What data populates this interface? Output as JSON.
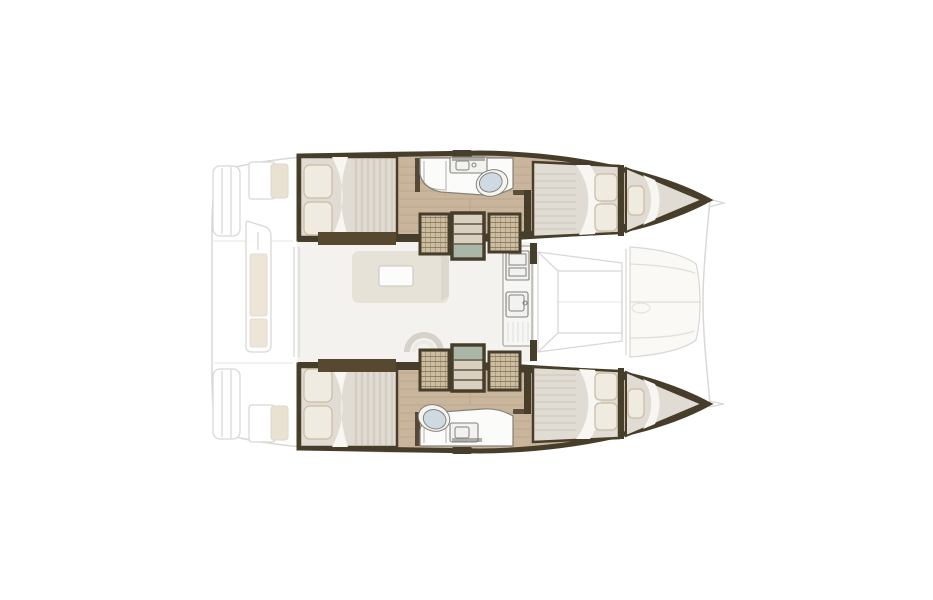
{
  "image": {
    "description": "Top-down interior layout plan of a catamaran yacht, bow pointing right, on a white background",
    "background": "#ffffff"
  },
  "colors": {
    "background": "#ffffff",
    "hull-wall": "#473d2b",
    "wood-floor": "#c8b59c",
    "wood-plank-line": "#b09c82",
    "mattress": "#e1dcd3",
    "mattress-stripe": "#d2ccc1",
    "bed-sheet": "#f7f6f2",
    "pillow": "#f0ebe1",
    "pillow-edge": "#c9bba2",
    "cabinet-hatch": "#cdbda0",
    "cabinet-line": "#6e6146",
    "stair-tread": "#d9d0c1",
    "stair-landing": "#a9b7a8",
    "bed-shelf": "#57492f",
    "bathroom-floor": "#fbfbf9",
    "fixture-line": "#85827b",
    "toilet": "#cfd9e2",
    "saloon-floor": "#f3f2ef",
    "sofa": "#e6e2d8",
    "table": "#fcfcfb",
    "galley-counter": "#f6f6f4",
    "deck-line": "#d9d8d5",
    "cushion": "#faf9f6",
    "cushion-beige": "#e9e1d2"
  },
  "boat": {
    "type": "catamaran",
    "view": "interior deck plan",
    "orientation": "bow-right",
    "areas": {
      "exterior": "Hull silhouette with aft swim steps and aft cockpit",
      "port_hull": "Port hull: aft double cabin, bathroom, wardrobes, companionway stairs, forward double cabin",
      "starboard_hull": "Starboard hull: aft double cabin, bathroom, wardrobes, companionway stairs, forward double cabin",
      "saloon": "Central saloon with sofa and coffee table",
      "galley": "Galley with stove, sink and cabinets on forward bulkhead",
      "foredeck": "Forward cockpit with walkway and lounge cushions",
      "aft_cockpit": "Aft cockpit with table and bench cushions",
      "port_bathroom": "Port bathroom with wash basin and marine toilet",
      "starboard_bathroom": "Starboard bathroom with marine toilet and wash basin"
    },
    "counts": {
      "double_cabins": 4,
      "bathrooms": 2,
      "companionways": 2
    }
  }
}
